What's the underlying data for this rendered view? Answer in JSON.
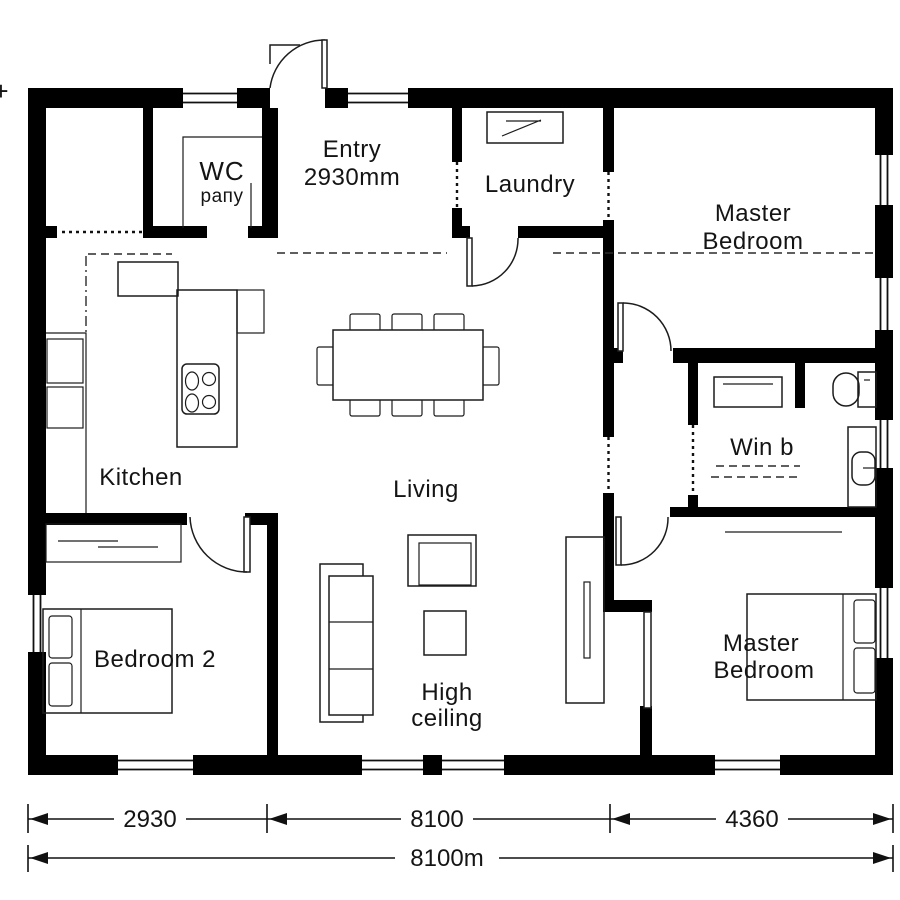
{
  "rooms": {
    "wc": {
      "name": "WC",
      "note": "paпy"
    },
    "entry": {
      "name": "Entry",
      "dimension": "2930mm"
    },
    "laundry": {
      "name": "Laundry"
    },
    "master_bedroom_top": {
      "line1": "Master",
      "line2": "Bedroom"
    },
    "kitchen": {
      "name": "Kitchen"
    },
    "living": {
      "name": "Living"
    },
    "win_b": {
      "name": "Win b"
    },
    "bedroom_2": {
      "name": "Bedroom 2"
    },
    "high_ceiling": {
      "line1": "High",
      "line2": "ceiling"
    },
    "master_bedroom_bottom": {
      "line1": "Master",
      "line2": "Bedroom"
    }
  },
  "dimensions": {
    "segments": [
      "2930",
      "8100",
      "4360"
    ],
    "total": "8100m"
  },
  "edge_mark": "+",
  "colors": {
    "wall": "#000000",
    "line": "#1c1c1c",
    "background": "#ffffff"
  }
}
